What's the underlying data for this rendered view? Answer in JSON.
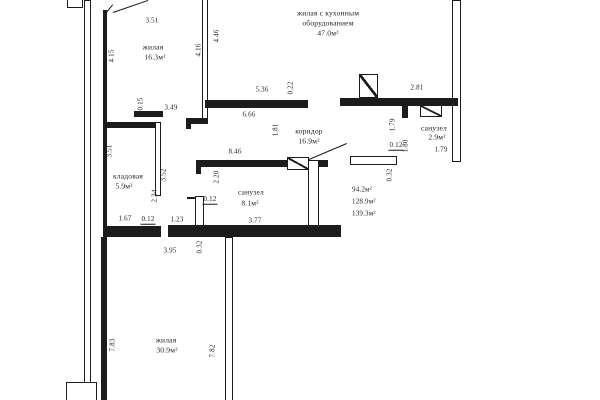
{
  "plan": {
    "rooms": {
      "living1": {
        "name": "жилая",
        "area": "16.3м²"
      },
      "kitchen": {
        "line1": "жилая с кухонным",
        "line2": "оборудованием",
        "area": "47.0м²"
      },
      "corridor": {
        "name": "коридор",
        "area": "16.9м²"
      },
      "storage": {
        "name": "кладовая",
        "area": "5.9м²"
      },
      "bath1": {
        "name": "санузел",
        "area": "8.1м²"
      },
      "bath2": {
        "name": "санузел",
        "area": "2.9м²"
      },
      "living2": {
        "name": "жилая",
        "area": "30.9м²"
      }
    },
    "totals": {
      "t1": "94.2м²",
      "t2": "128.9м²",
      "t3": "139.3м²"
    },
    "dims": {
      "room1_top": "3.51",
      "room1_left": "4.15",
      "room1_right_in": "4.16",
      "room1_right_out": "4.46",
      "room1_wall": "0.15",
      "room1_bottom": "3.49",
      "kitchen_opening": "5.36",
      "kitchen_wall": "0.22",
      "kitchen_bottom": "6.66",
      "corridor_left": "1.81",
      "kitchen_right": "2.81",
      "bath1_top": "8.46",
      "bath1_left": "2.34",
      "bath1_inner": "2.20",
      "bath1_wall": "0.12",
      "bath1_bottom": "3.77",
      "bath2_left": "1.79",
      "bath2_wall": "0.12",
      "bath2_door": "1.80",
      "bath2_bottom": "1.79",
      "bath2_out": "0.32",
      "storage_left": "3.51",
      "storage_right": "3.52",
      "storage_bottom": "1.67",
      "storage_wall": "0.12",
      "door_bottom": "1.23",
      "room2_top": "3.95",
      "room2_wall": "0.32",
      "room2_left": "7.83",
      "room2_right": "7.82"
    }
  }
}
